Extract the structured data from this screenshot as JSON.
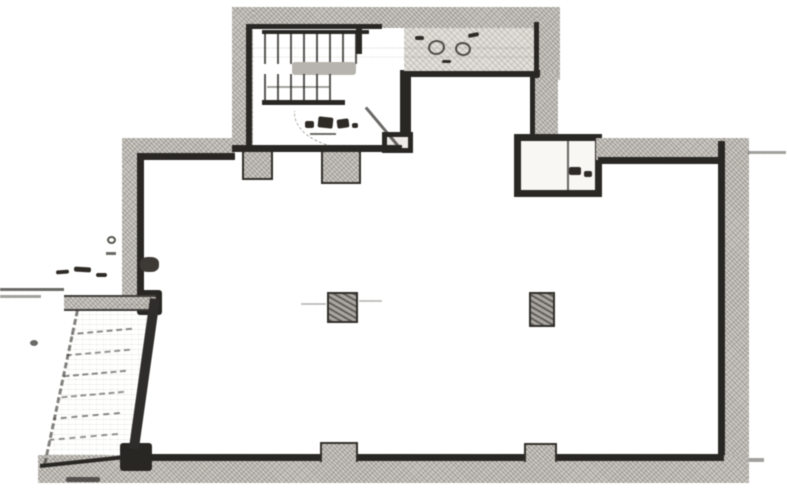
{
  "document": {
    "kind": "scanned-floor-plan",
    "legible_text": [],
    "annotations": [
      {
        "location": "stairwell",
        "text": "(illegible scribble)"
      },
      {
        "location": "upper-landing",
        "text": "(illegible scribble)"
      },
      {
        "location": "pipe-shaft",
        "text": "(illegible marks)"
      },
      {
        "location": "outside-left-wall",
        "text": "(illegible marks)"
      }
    ]
  },
  "colors": {
    "paper": "#fcfcfb",
    "wall_fill": "#c9c6c1",
    "ink": "#2e2c29"
  },
  "features": [
    {
      "name": "stair-tower",
      "contains": [
        "u-shaped-staircase",
        "mid-landing",
        "upper-landing-area",
        "entrance-notch",
        "door-swing"
      ]
    },
    {
      "name": "main-hall",
      "contains": [
        "column-a",
        "column-b",
        "wall-piers-top",
        "wall-piers-bottom"
      ]
    },
    {
      "name": "pipe-shaft",
      "position": "top junction, right of entrance notch"
    },
    {
      "name": "external-stair-annex",
      "position": "lower-left, slanted parallelogram with tread lines"
    }
  ]
}
